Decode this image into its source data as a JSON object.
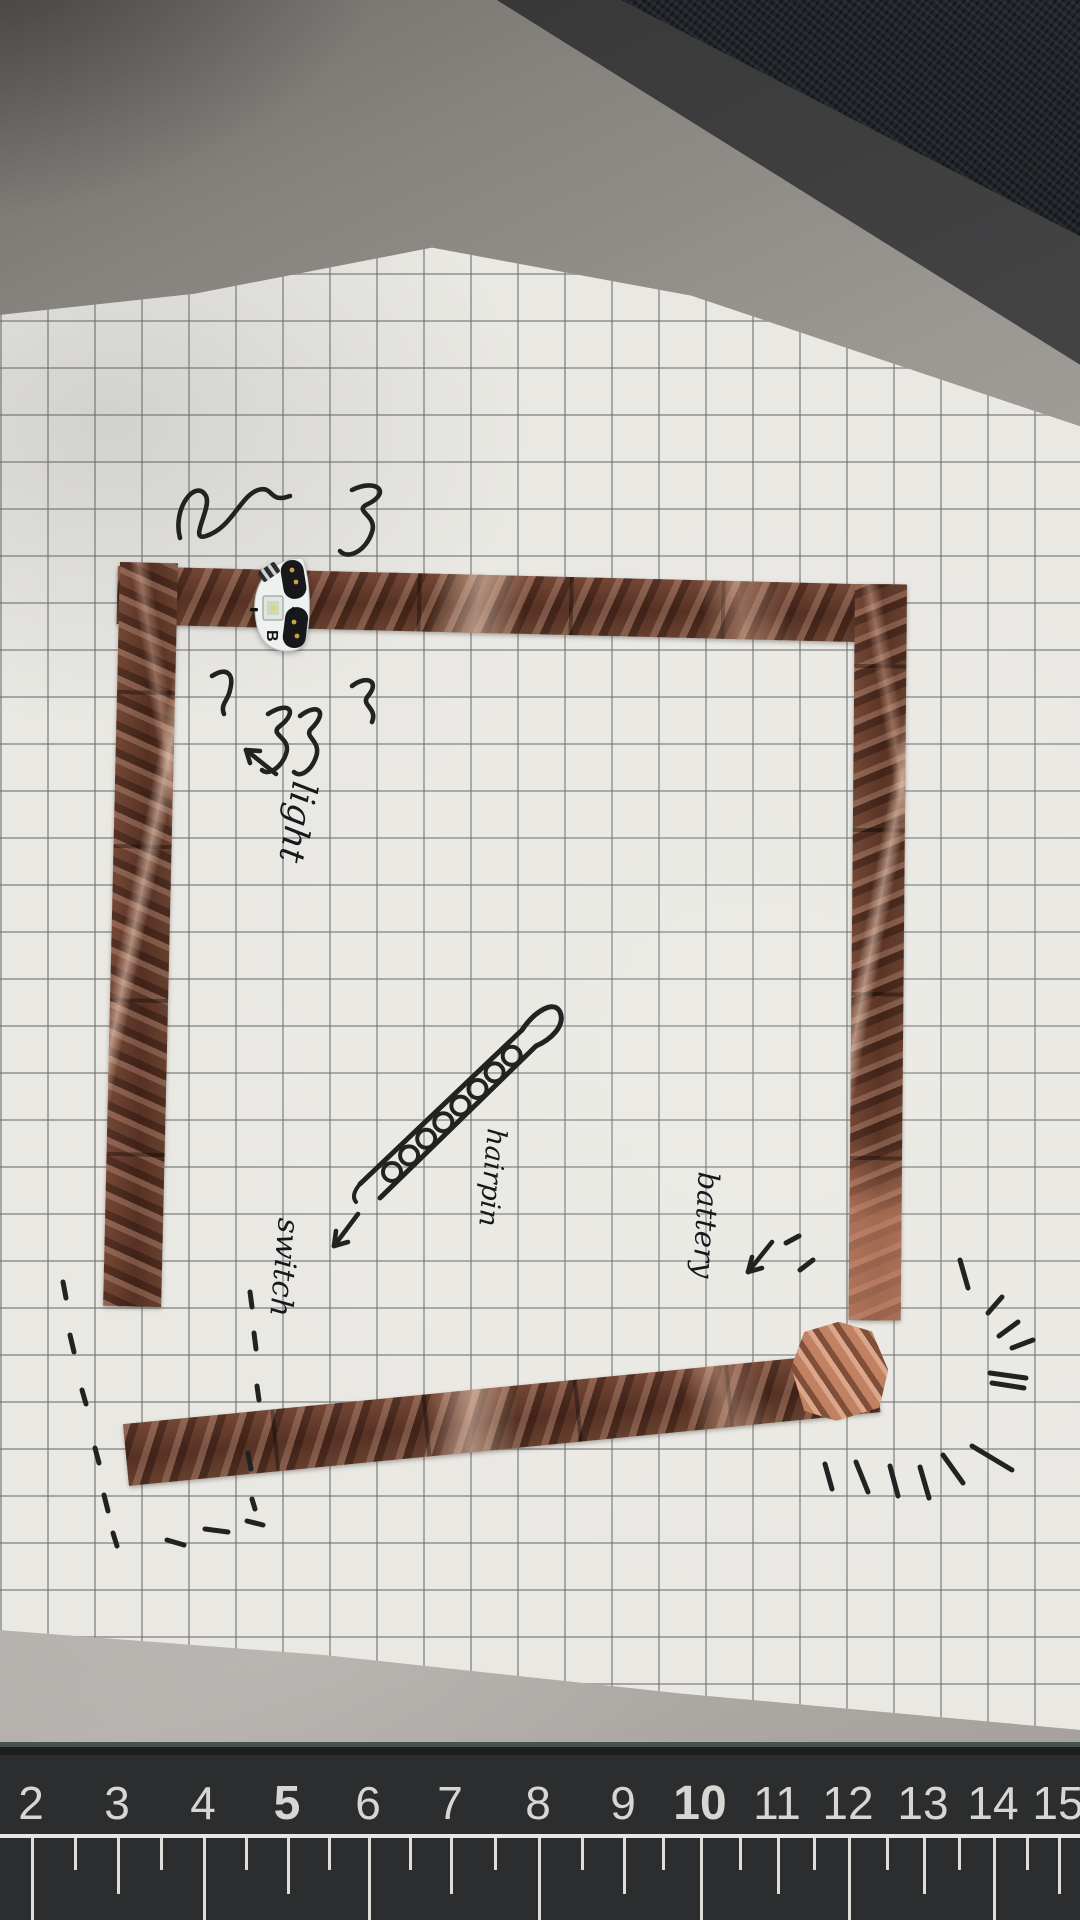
{
  "annotations": {
    "light": "light",
    "hairpin": "hairpin",
    "switch": "switch",
    "battery": "battery"
  },
  "led_sticker": {
    "letter": "B",
    "plus_mark": "+"
  },
  "ruler": {
    "numbers": [
      {
        "label": "2",
        "x": 31
      },
      {
        "label": "3",
        "x": 117
      },
      {
        "label": "4",
        "x": 203
      },
      {
        "label": "5",
        "x": 287
      },
      {
        "label": "6",
        "x": 368
      },
      {
        "label": "7",
        "x": 450
      },
      {
        "label": "8",
        "x": 538
      },
      {
        "label": "9",
        "x": 623
      },
      {
        "label": "10",
        "x": 700
      },
      {
        "label": "11",
        "x": 777
      },
      {
        "label": "12",
        "x": 848
      },
      {
        "label": "13",
        "x": 923
      },
      {
        "label": "14",
        "x": 993
      },
      {
        "label": "15",
        "x": 1058
      }
    ],
    "bold_labels": [
      "5",
      "10"
    ]
  },
  "marks": {
    "rays": [
      [
        968,
        1288,
        960,
        1260
      ],
      [
        1002,
        1297,
        988,
        1313
      ],
      [
        1018,
        1322,
        999,
        1336
      ],
      [
        1033,
        1340,
        1012,
        1348
      ],
      [
        990,
        1373,
        1026,
        1378
      ],
      [
        992,
        1383,
        1024,
        1388
      ],
      [
        825,
        1464,
        832,
        1489
      ],
      [
        856,
        1462,
        868,
        1492
      ],
      [
        890,
        1466,
        898,
        1496
      ],
      [
        920,
        1467,
        929,
        1498
      ],
      [
        943,
        1455,
        963,
        1483
      ],
      [
        972,
        1446,
        1012,
        1470
      ],
      [
        786,
        1243,
        799,
        1236
      ],
      [
        800,
        1270,
        813,
        1260
      ]
    ],
    "dashes": [
      [
        63,
        1282,
        66,
        1298
      ],
      [
        70,
        1335,
        74,
        1352
      ],
      [
        82,
        1390,
        86,
        1404
      ],
      [
        95,
        1448,
        99,
        1463
      ],
      [
        104,
        1495,
        108,
        1511
      ],
      [
        113,
        1533,
        117,
        1546
      ],
      [
        167,
        1540,
        184,
        1545
      ],
      [
        205,
        1529,
        228,
        1532
      ],
      [
        247,
        1521,
        263,
        1525
      ],
      [
        250,
        1292,
        252,
        1307
      ],
      [
        254,
        1333,
        256,
        1349
      ],
      [
        257,
        1386,
        259,
        1400
      ],
      [
        248,
        1453,
        251,
        1469
      ],
      [
        252,
        1499,
        255,
        1509
      ]
    ],
    "hairpin_loops": {
      "count": 8,
      "start": [
        392,
        1172
      ],
      "step": [
        17.1,
        -16.6
      ],
      "radius": 9
    }
  },
  "colors": {
    "copper": "#6b4434",
    "copper_dark": "#3f241c",
    "copper_light": "#cf9b7c",
    "paper": "#e9e8e3",
    "mat": "#2b2d2e",
    "desk": "#a19d99",
    "ink": "#222222"
  }
}
